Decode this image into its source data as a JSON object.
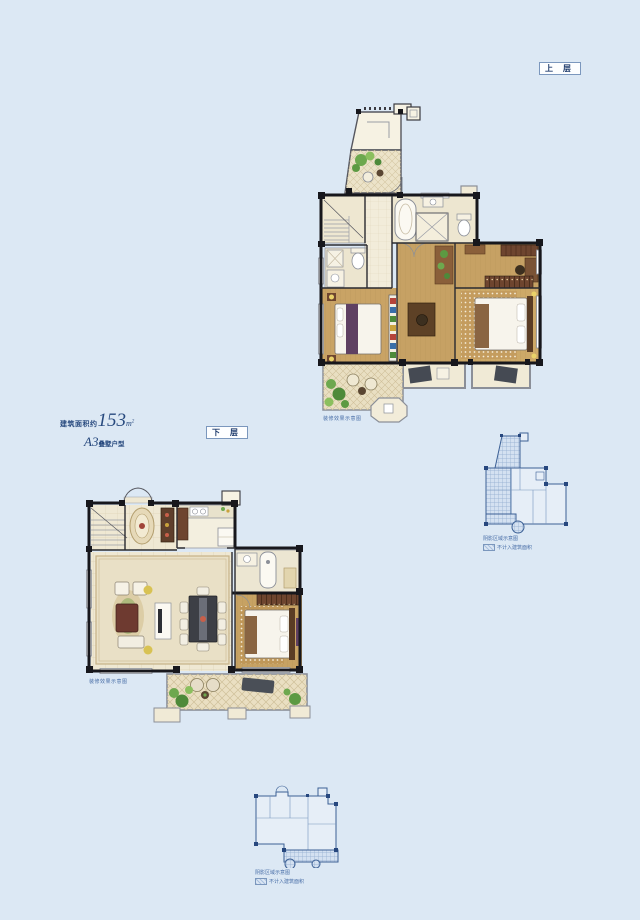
{
  "labels": {
    "upper_floor": "上 层",
    "lower_floor": "下 层"
  },
  "info": {
    "area_prefix": "建筑面积约",
    "area_number": "153",
    "area_unit": "m",
    "area_sup": "2",
    "type_code": "A3",
    "type_suffix": "叠墅户型"
  },
  "captions": {
    "upper_plan": "装修效果示意图",
    "lower_plan": "装修效果示意图",
    "keyplan_line1": "阴影区域示意图",
    "keyplan_line2": "不计入建筑面积"
  },
  "colors": {
    "background": "#dce8f4",
    "navy_text": "#1d3a6b",
    "caption_blue": "#4a6fa8",
    "wall_black": "#17171c",
    "wood_floor": "#c7a263",
    "cream_tile": "#efe8d3",
    "keyplan_stroke": "#3c6095"
  }
}
